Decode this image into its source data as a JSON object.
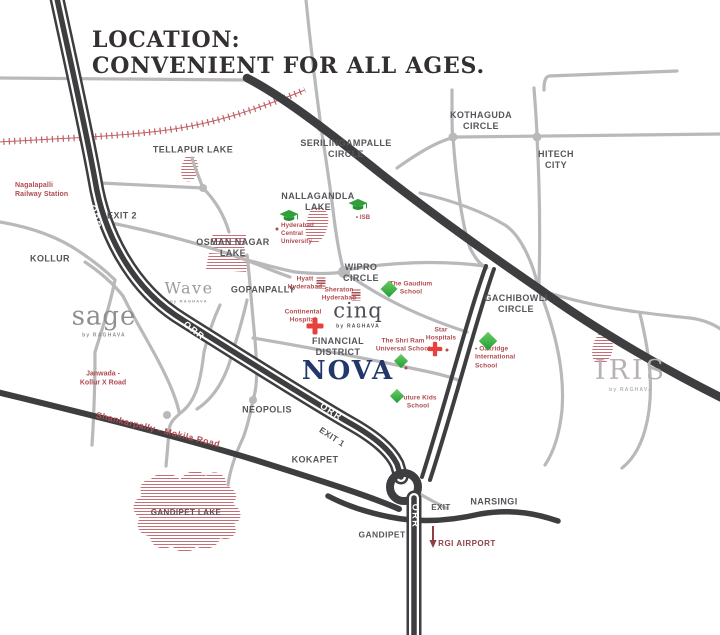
{
  "title": {
    "line1": "LOCATION:",
    "line2": "CONVENIENT FOR ALL AGES."
  },
  "colors": {
    "road_dark": "#3e3e40",
    "road_gray": "#b9b9bb",
    "label_dark": "#55565a",
    "poi_red": "#b04b50",
    "school_green": "#2ea13a",
    "hospital_red": "#e8413d",
    "lake_hatch_red": "#bf6066",
    "nova_navy": "#22386b",
    "airport_maroon": "#8e3f44"
  },
  "roads": {
    "orr": "ORR",
    "exit_1": "EXIT 1",
    "exit_2": "EXIT 2",
    "exit": "EXIT",
    "janwada": "Janwada -\nKollur X Road",
    "shankarpally": "Shankarpally - Mokila Road"
  },
  "places": {
    "tellapur_lake": "TELLAPUR LAKE",
    "kollur": "KOLLUR",
    "osman_nagar_lake": "OSMAN NAGAR\nLAKE",
    "serilingampalle_circle": "SERILINGAMPALLE\nCIRCLE",
    "nallagandla_lake": "NALLAGANDLA\nLAKE",
    "kothaguda_circle": "KOTHAGUDA\nCIRCLE",
    "hitech_city": "HITECH\nCITY",
    "gopanpally": "GOPANPALLY",
    "wipro_circle": "WIPRO\nCIRCLE",
    "gachibowli_circle": "GACHIBOWLI\nCIRCLE",
    "financial_district": "FINANCIAL\nDISTRICT",
    "neopolis": "NEOPOLIS",
    "kokapet": "KOKAPET",
    "gandipet_lake": "GANDIPET LAKE",
    "gandipet": "GANDIPET",
    "narsingi": "NARSINGI"
  },
  "landmarks": {
    "nagalapalli_station": "Nagalapalli\nRailway Station",
    "isb": "• ISB",
    "hcu": "Hyderabad\nCentral\nUniversity",
    "hyatt": "Hyatt\nHyderabad",
    "sheraton": "Sheraton\nHyderabad",
    "gaudium": "The Gaudium\nSchool",
    "continental": "Continental\nHospital",
    "shri_ram": "The Shri Ram\nUniversal School",
    "star": "Star\nHospitals",
    "oakridge": "• Oakridge\nInternational\nSchool",
    "future_kids": "Future Kids\nSchool",
    "rgi_airport": "RGI AIRPORT"
  },
  "projects": {
    "sage": {
      "name": "sage",
      "by": "by RAGHAVA"
    },
    "wave": {
      "name": "Wave",
      "by": "by RAGHAVA"
    },
    "cinq": {
      "name": "cinq",
      "by": "by RAGHAVA"
    },
    "nova": {
      "name": "NOVA"
    },
    "iris": {
      "name": "IRIS",
      "by": "by RAGHAVA"
    }
  }
}
